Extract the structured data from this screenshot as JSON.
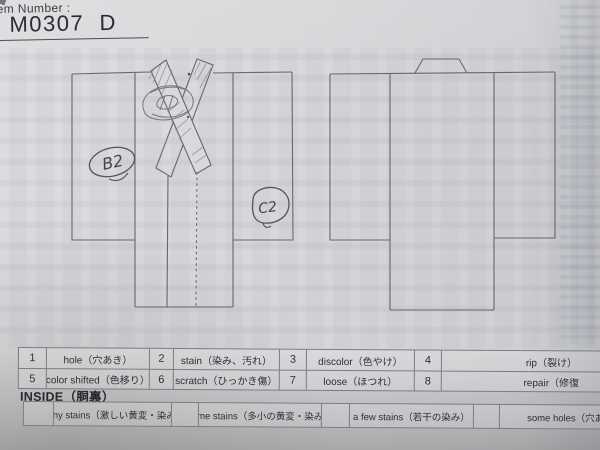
{
  "header": {
    "label": "Item Number :",
    "number": "M0307  D"
  },
  "annotations": {
    "front_left_sleeve": "B2",
    "front_right_body": "C2"
  },
  "legend": {
    "cells": [
      {
        "num": "1",
        "label": "hole（穴あき）"
      },
      {
        "num": "2",
        "label": "stain（染み、汚れ）"
      },
      {
        "num": "3",
        "label": "discolor（色やけ）"
      },
      {
        "num": "4",
        "label": "rip（裂け）"
      },
      {
        "num": "5",
        "label": "color shifted（色移り）"
      },
      {
        "num": "6",
        "label": "scratch（ひっかき傷）"
      },
      {
        "num": "7",
        "label": "loose（ほつれ）"
      },
      {
        "num": "8",
        "label": "repair（修復"
      }
    ]
  },
  "inside": {
    "heading": "INSIDE（胴裏）",
    "options": [
      "many stains（激しい黄変・染み）",
      "some stains（多小の黄変・染み）",
      "a few stains（若干の染み）",
      "some holes（穴あり"
    ]
  },
  "colors": {
    "paper": "#d7d8da",
    "diagram_line": "#67676d",
    "handwriting_ink": "#45454b",
    "table_border": "#7c7c83",
    "text": "#2e2e34"
  }
}
